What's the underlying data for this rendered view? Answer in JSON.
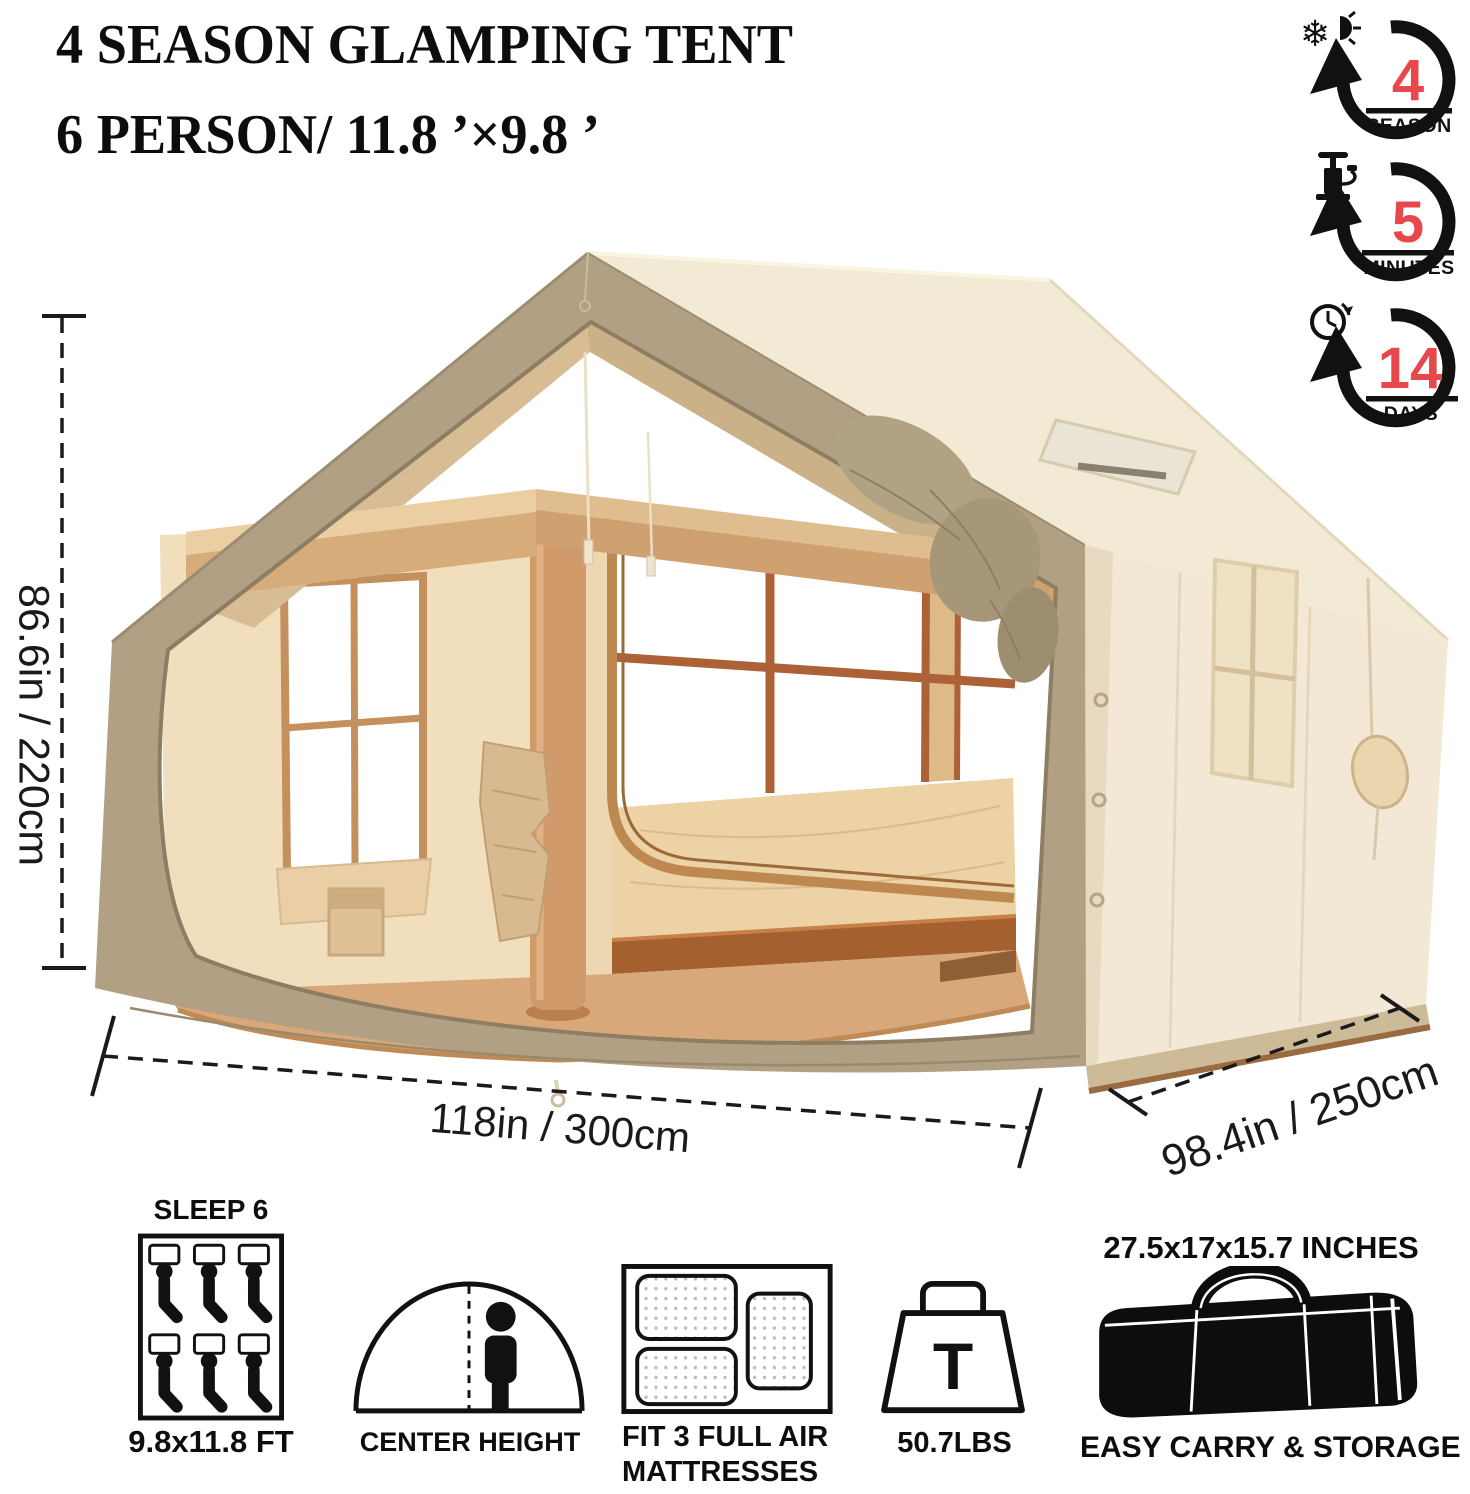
{
  "title": {
    "line1": "4 SEASON GLAMPING TENT",
    "line2": "6 PERSON/ 11.8 ’×9.8 ’"
  },
  "badges": [
    {
      "icon": "snowflake-sun-icon",
      "icon_glyph": "❄",
      "value": "4",
      "label": "SEASON"
    },
    {
      "icon": "air-pump-icon",
      "value": "5",
      "label": "MINUTES"
    },
    {
      "icon": "clock-icon",
      "value": "14",
      "label": "DAYS"
    }
  ],
  "dimensions": {
    "height": "86.6in / 220cm",
    "width": "118in / 300cm",
    "depth": "98.4in / 250cm"
  },
  "features": [
    {
      "icon": "sleep-6-icon",
      "title": "SLEEP 6",
      "caption": "9.8x11.8 FT"
    },
    {
      "icon": "center-height-icon",
      "caption": "CENTER HEIGHT"
    },
    {
      "icon": "air-mattress-icon",
      "caption_line1": "FIT 3 FULL AIR",
      "caption_line2": "MATTRESSES"
    },
    {
      "icon": "weight-icon",
      "glyph": "T",
      "caption": "50.7LBS"
    },
    {
      "icon": "carry-bag-icon",
      "title": "27.5x17x15.7 INCHES",
      "caption": "EASY CARRY & STORAGE"
    }
  ],
  "colors": {
    "accent_red": "#E8484B",
    "roof_khaki": "#B1A083",
    "wall_cream": "#F2E8D5",
    "interior_tan": "#D6AC7B",
    "floor_tan": "#D8A87A",
    "frame_brown": "#AD6136"
  }
}
